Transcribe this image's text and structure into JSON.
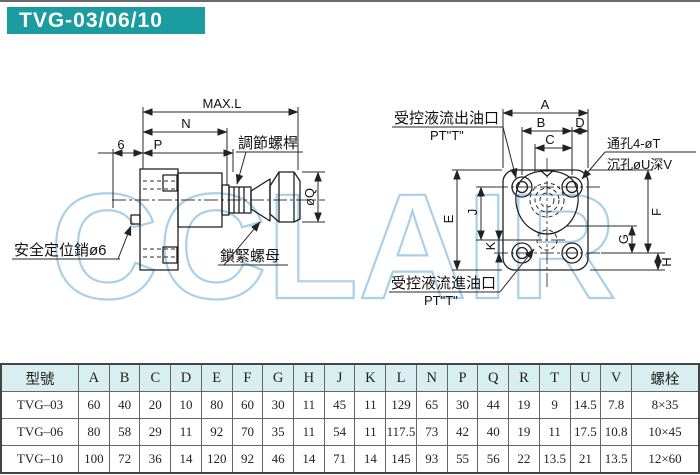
{
  "title": "TVG-03/06/10",
  "watermark": "CCLAIR",
  "colors": {
    "title_bg": "#1b9ca1",
    "title_text": "#ffffff",
    "table_header_bg": "#d9eef1",
    "watermark_blue": "#a9cfe9",
    "drawing_line": "#222222"
  },
  "side_view": {
    "dim_max_l": "MAX.L",
    "dim_n": "N",
    "dim_6": "6",
    "dim_p": "P",
    "dim_q": "øQ",
    "label_adjust_screw": "調節螺桿",
    "label_lock_nut": "鎖緊螺母",
    "label_safety_pin": "安全定位銷ø6"
  },
  "front_view": {
    "dim_a": "A",
    "dim_b": "B",
    "dim_c": "C",
    "dim_d": "D",
    "dim_e": "E",
    "dim_f": "F",
    "dim_g": "G",
    "dim_h": "H",
    "dim_j": "J",
    "dim_k": "K",
    "label_outlet": "受控液流出油口",
    "label_outlet_port": "PT\"T\"",
    "label_inlet": "受控液流進油口",
    "label_inlet_port": "PT\"T\"",
    "label_through_hole": "通孔4-øT",
    "label_counterbore": "沉孔øU深V"
  },
  "table": {
    "columns": [
      "型號",
      "A",
      "B",
      "C",
      "D",
      "E",
      "F",
      "G",
      "H",
      "J",
      "K",
      "L",
      "N",
      "P",
      "Q",
      "R",
      "T",
      "U",
      "V",
      "螺栓"
    ],
    "rows": [
      [
        "TVG–03",
        "60",
        "40",
        "20",
        "10",
        "80",
        "60",
        "30",
        "11",
        "45",
        "11",
        "129",
        "65",
        "30",
        "44",
        "19",
        "9",
        "14.5",
        "7.8",
        "8×35"
      ],
      [
        "TVG–06",
        "80",
        "58",
        "29",
        "11",
        "92",
        "70",
        "35",
        "11",
        "54",
        "11",
        "117.5",
        "73",
        "42",
        "40",
        "19",
        "11",
        "17.5",
        "10.8",
        "10×45"
      ],
      [
        "TVG–10",
        "100",
        "72",
        "36",
        "14",
        "120",
        "92",
        "46",
        "14",
        "71",
        "14",
        "145",
        "93",
        "55",
        "56",
        "22",
        "13.5",
        "21",
        "13.5",
        "12×60"
      ]
    ]
  }
}
